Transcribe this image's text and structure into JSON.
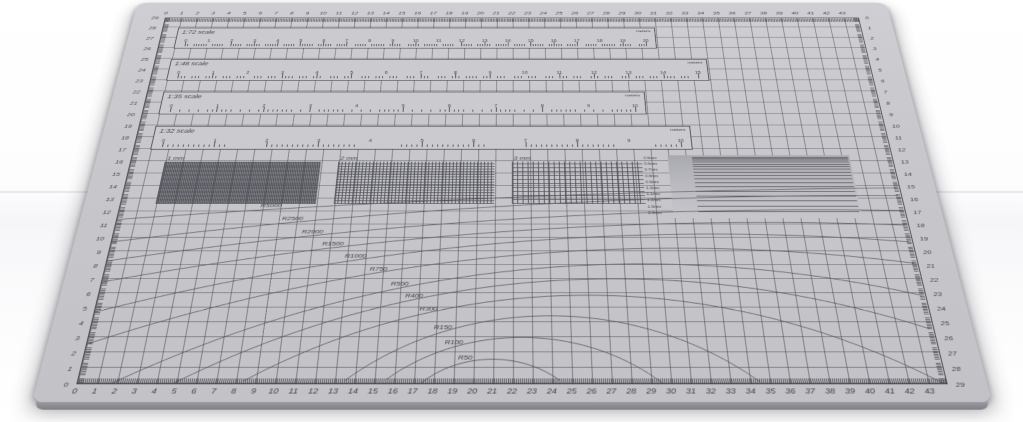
{
  "photo": {
    "subject": "gray self-healing cutting mat photographed in perspective on white surface",
    "mat_color": "#c8c8cc",
    "line_color": "#45454c",
    "background_color": "#ffffff"
  },
  "edges": {
    "bottom_numbers": [
      0,
      1,
      2,
      3,
      4,
      5,
      6,
      7,
      8,
      9,
      10,
      11,
      12,
      13,
      14,
      15,
      16,
      17,
      18,
      19,
      20,
      21,
      22,
      23,
      24,
      25,
      26,
      27,
      28,
      29,
      30,
      31,
      32,
      33,
      34,
      35,
      36,
      37,
      38,
      39,
      40,
      41,
      42,
      43
    ],
    "top_numbers": [
      0,
      1,
      2,
      3,
      4,
      5,
      6,
      7,
      8,
      9,
      10,
      11,
      12,
      13,
      14,
      15,
      16,
      17,
      18,
      19,
      20,
      21,
      22,
      23,
      24,
      25,
      26,
      27,
      28,
      29,
      30,
      31,
      32,
      33,
      34,
      35,
      36,
      37,
      38,
      39,
      40,
      41,
      42,
      43
    ],
    "left_numbers": [
      0,
      1,
      2,
      3,
      4,
      5,
      6,
      7,
      8,
      9,
      10,
      11,
      12,
      13,
      14,
      15,
      16,
      17,
      18,
      19,
      20,
      21,
      22,
      23,
      24,
      25,
      26,
      27,
      28,
      29
    ],
    "right_numbers": [
      0,
      1,
      2,
      3,
      4,
      5,
      6,
      7,
      8,
      9,
      10,
      11,
      12,
      13,
      14,
      15,
      16,
      17,
      18,
      19,
      20,
      21,
      22,
      23,
      24,
      25,
      26,
      27,
      28,
      29
    ]
  },
  "scale_rulers": [
    {
      "label": "1:72 scale",
      "unit": "meters",
      "numbers": [
        0,
        1,
        2,
        3,
        4,
        5,
        6,
        7,
        8,
        9,
        10,
        11,
        12,
        13,
        14,
        15,
        16,
        17,
        18,
        19,
        20
      ]
    },
    {
      "label": "1:48 scale",
      "unit": "meters",
      "numbers": [
        0,
        1,
        2,
        3,
        4,
        5,
        6,
        7,
        8,
        9,
        10,
        11,
        12,
        13,
        14,
        15
      ]
    },
    {
      "label": "1:35 scale",
      "unit": "meters",
      "numbers": [
        0,
        1,
        2,
        3,
        4,
        5,
        6,
        7,
        8,
        9,
        10
      ]
    },
    {
      "label": "1:32 scale",
      "unit": "meters",
      "numbers": [
        0,
        1,
        2,
        3,
        4,
        5,
        6,
        7,
        8,
        9,
        10
      ]
    }
  ],
  "grid_swatches": [
    {
      "label": "1 mm",
      "pitch_px": 2
    },
    {
      "label": "2 mm",
      "pitch_px": 4
    },
    {
      "label": "3 mm",
      "pitch_px": 6
    }
  ],
  "line_gauge": {
    "labels": [
      "0.5mm",
      "0.6mm",
      "0.7mm",
      "0.8mm",
      "0.9mm",
      "1.0mm",
      "1.1mm",
      "1.2mm",
      "1.5mm",
      "2.0mm"
    ]
  },
  "radius_curves": [
    {
      "label": "R5000",
      "r_cm": 500,
      "xc": 50,
      "xl": 8.5,
      "hl": 12.2
    },
    {
      "label": "R2500",
      "r_cm": 250,
      "xc": 42,
      "xl": 9.8,
      "hl": 11.2
    },
    {
      "label": "R2000",
      "r_cm": 200,
      "xc": 39,
      "xl": 11.0,
      "hl": 10.2
    },
    {
      "label": "R1500",
      "r_cm": 150,
      "xc": 36,
      "xl": 12.2,
      "hl": 9.3
    },
    {
      "label": "R1000",
      "r_cm": 100,
      "xc": 33,
      "xl": 13.5,
      "hl": 8.4
    },
    {
      "label": "R750",
      "r_cm": 75,
      "xc": 31,
      "xl": 14.8,
      "hl": 7.5
    },
    {
      "label": "R500",
      "r_cm": 50,
      "xc": 29,
      "xl": 16.0,
      "hl": 6.4
    },
    {
      "label": "R400",
      "r_cm": 40,
      "xc": 27.5,
      "xl": 16.8,
      "hl": 5.6
    },
    {
      "label": "R300",
      "r_cm": 30,
      "xc": 26,
      "xl": 17.6,
      "hl": 4.7
    },
    {
      "label": "R150",
      "r_cm": 15,
      "xc": 24,
      "xl": 18.4,
      "hl": 3.4
    },
    {
      "label": "R100",
      "r_cm": 10,
      "xc": 22.5,
      "xl": 19.0,
      "hl": 2.4
    },
    {
      "label": "R50",
      "r_cm": 5,
      "xc": 21,
      "xl": 19.6,
      "hl": 1.4
    }
  ]
}
